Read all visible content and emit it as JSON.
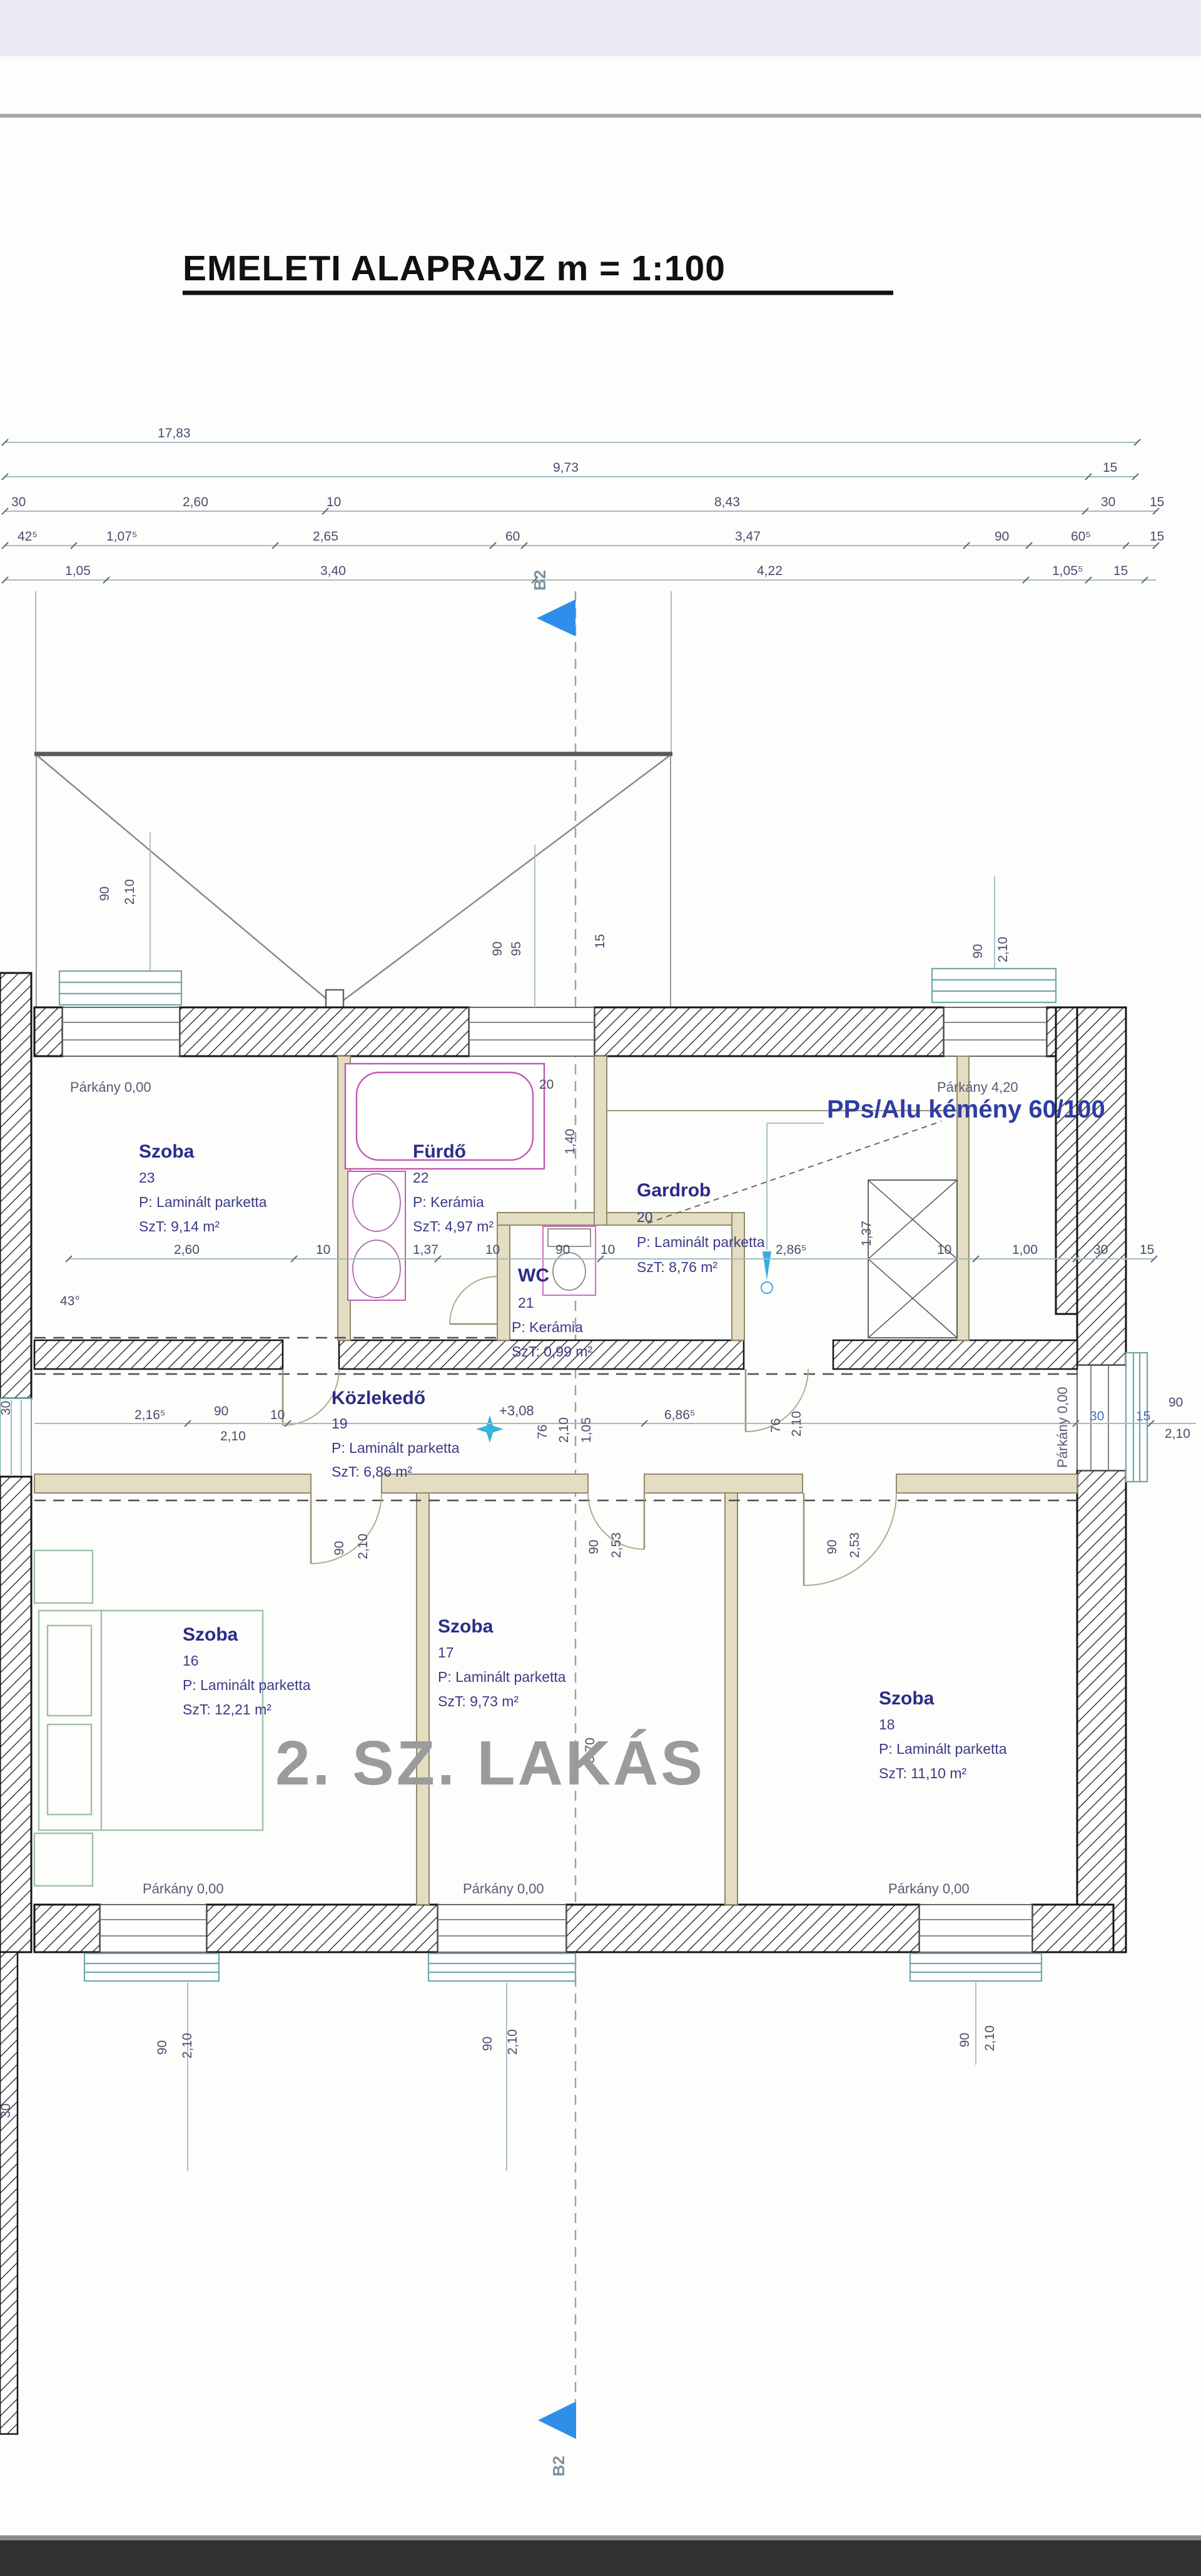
{
  "page": {
    "title": "EMELETI ALAPRAJZ m = 1:100"
  },
  "labels": {
    "unit": "2. SZ. LAKÁS",
    "chimney": "PPs/Alu kémény 60/100",
    "section": "B2",
    "level": "+3,08",
    "angle": "43°",
    "slope_height": "3,70",
    "parkany_000": "Párkány 0,00",
    "parkany_420": "Párkány 4,20"
  },
  "rooms": [
    {
      "name": "Szoba",
      "number": "23",
      "floor": "P: Laminált parketta",
      "area": "SzT: 9,14 m²"
    },
    {
      "name": "Fürdő",
      "number": "22",
      "floor": "P: Kerámia",
      "area": "SzT: 4,97 m²"
    },
    {
      "name": "WC",
      "number": "21",
      "floor": "P: Kerámia",
      "area": "SzT: 0,99 m²"
    },
    {
      "name": "Gardrob",
      "number": "20",
      "floor": "P: Laminált parketta",
      "area": "SzT: 8,76 m²"
    },
    {
      "name": "Közlekedő",
      "number": "19",
      "floor": "P: Laminált parketta",
      "area": "SzT: 6,86 m²"
    },
    {
      "name": "Szoba",
      "number": "16",
      "floor": "P: Laminált parketta",
      "area": "SzT: 12,21 m²"
    },
    {
      "name": "Szoba",
      "number": "17",
      "floor": "P: Laminált parketta",
      "area": "SzT: 9,73 m²"
    },
    {
      "name": "Szoba",
      "number": "18",
      "floor": "P: Laminált parketta",
      "area": "SzT: 11,10 m²"
    }
  ],
  "dims": {
    "row1": [
      "17,83"
    ],
    "row2": [
      "9,73",
      "15"
    ],
    "row3": [
      "30",
      "2,60",
      "10",
      "8,43",
      "30",
      "15"
    ],
    "row4": [
      "42⁵",
      "1,07⁵",
      "2,65",
      "60",
      "3,47",
      "90",
      "60⁵",
      "15"
    ],
    "row5": [
      "1,05",
      "3,40",
      "4,22",
      "1,05⁵",
      "15"
    ],
    "mid": [
      "2,60",
      "10",
      "1,37",
      "10",
      "90",
      "10",
      "2,86⁵",
      "10",
      "1,00",
      "30",
      "15"
    ],
    "mid_rot": "1,37",
    "corridor": [
      "2,16⁵",
      "90",
      "2,10",
      "10",
      "76",
      "2,10",
      "1,05",
      "6,86⁵",
      "76",
      "2,10",
      "30",
      "15",
      "90",
      "2,10"
    ],
    "win_t1": [
      "90",
      "2,10"
    ],
    "win_t2": [
      "90",
      "95"
    ],
    "win_t3": [
      "90",
      "2,10"
    ],
    "win_b": [
      "90",
      "2,10"
    ],
    "doors": {
      "d16": [
        "90",
        "2,10"
      ],
      "d17": [
        "90",
        "2,53"
      ],
      "d18": [
        "90",
        "2,53"
      ]
    },
    "strip": [
      "30",
      "30"
    ],
    "attic_15": "15",
    "tub_end": "20",
    "tub_side": "1,40"
  }
}
